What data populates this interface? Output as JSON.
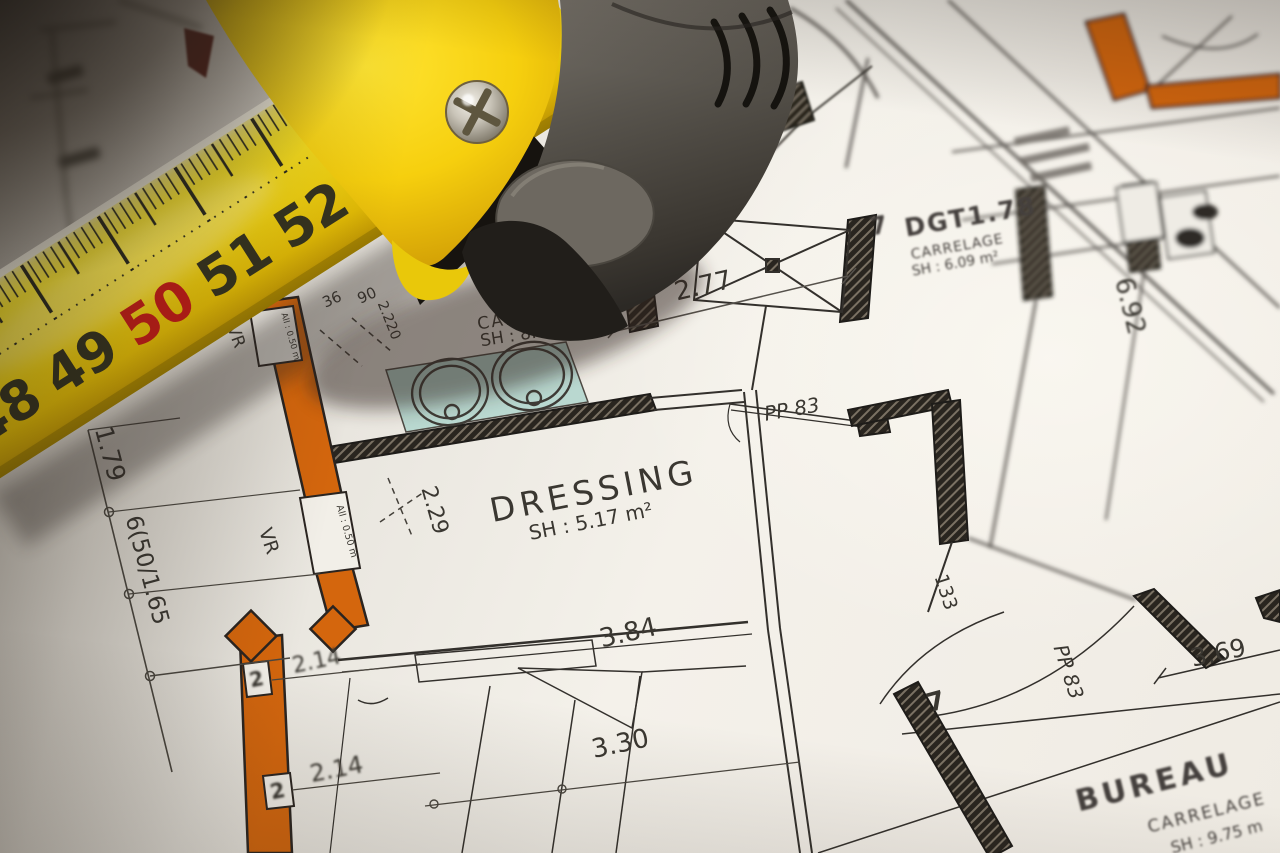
{
  "tape_measure": {
    "scale_numbers": [
      "48",
      "49",
      "50",
      "51",
      "52"
    ],
    "red_number": "50",
    "blade_color": "#f2d312",
    "case_yellow": "#f6cf0e",
    "case_gray": "#57534c",
    "red_accent": "#c01d17"
  },
  "floor_plan": {
    "accent_wall_color": "#d4660d",
    "fixture_fill_color": "#b9d8d0",
    "rooms": {
      "bains": {
        "name": "AINS",
        "finish": "CARRELAGE",
        "area": "SH : 8.52 m²"
      },
      "dgt": {
        "number": "7",
        "name": "DGT1.78",
        "finish": "CARRELAGE",
        "area": "SH : 6.09 m²"
      },
      "dressing": {
        "name": "DRESSING",
        "area": "SH : 5.17 m²"
      },
      "bureau": {
        "name": "BUREAU",
        "finish": "CARRELAGE",
        "area": "SH : 9.75 m"
      }
    },
    "dimensions": {
      "top": "2.77",
      "right": "6.92",
      "left_upper": "1.79",
      "left_lower": "6(50/1.65",
      "window_w1": "36",
      "window_w2": "90",
      "window_h": "2.220",
      "sill_upper": "All : 0.50 m",
      "sill_lower": "All : 0.50 m",
      "vr_upper": "VR",
      "vr_lower": "VR",
      "dressing_v": "2.29",
      "bottom_1": "3.84",
      "bottom_2": "3.30",
      "left_d1": "2.14",
      "left_d2": "2.14",
      "wall_tag1": "2",
      "wall_tag2": "2",
      "door_top": "PP 83",
      "door_bottom": "PP 83",
      "arc_133": "133",
      "bureau_w": "3.69",
      "bottom_7": "7"
    }
  }
}
